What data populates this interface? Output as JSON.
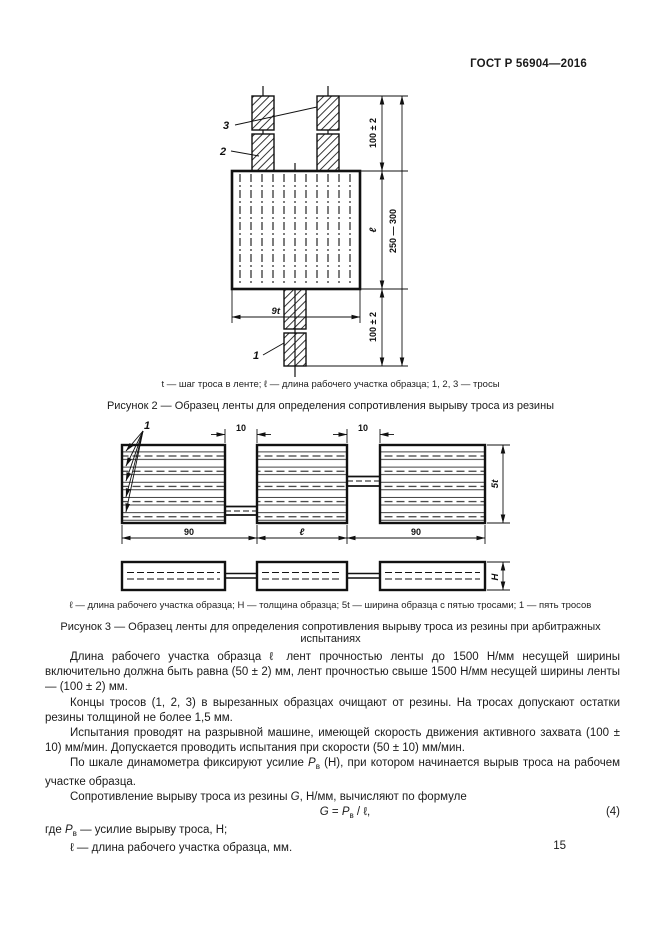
{
  "header": {
    "title": "ГОСТ Р 56904—2016"
  },
  "figure2": {
    "callout_1": "1",
    "callout_2": "2",
    "callout_3": "3",
    "dim_top": "100 ± 2",
    "dim_length": "ℓ",
    "dim_bottom": "100 ± 2",
    "dim_overall": "250 — 300",
    "dim_width": "9t",
    "legend": "t — шаг троса в ленте; ℓ — длина рабочего участка образца; 1, 2, 3 — тросы",
    "title": "Рисунок 2 — Образец ленты для определения сопротивления вырыву троса из резины"
  },
  "figure3": {
    "callout_1": "1",
    "dim_neck_left": "10",
    "dim_neck_right": "10",
    "dim_left": "90",
    "dim_middle": "ℓ",
    "dim_right": "90",
    "dim_width": "5t",
    "dim_thickness": "H",
    "legend": "ℓ — длина рабочего участка образца; H — толщина образца; 5t — ширина образца с пятью тросами; 1 — пять тросов",
    "title": "Рисунок 3 — Образец ленты для определения сопротивления вырыву троса из резины при арбитражных испытаниях"
  },
  "body": {
    "p1": "Длина рабочего участка образца ℓ лент прочностью ленты до 1500 Н/мм несущей ширины включительно должна быть равна (50 ± 2) мм, лент прочностью свыше 1500 Н/мм несущей ширины ленты — (100 ± 2) мм.",
    "p2": "Концы тросов (1, 2, 3) в вырезанных образцах очищают от резины. На тросах допускают остатки резины толщиной не более 1,5 мм.",
    "p3": "Испытания проводят на разрывной машине, имеющей скорость движения активного захвата (100 ± 10) мм/мин. Допускается проводить испытания при скорости (50 ± 10) мм/мин.",
    "p4_before": "По шкале динамометра фиксируют усилие ",
    "p4_var": "P",
    "p4_sub": "в",
    "p4_after": " (Н), при котором начинается вырыв троса на рабочем участке образца.",
    "p5_before": "Сопротивление вырыву троса из резины ",
    "p5_var": "G",
    "p5_after": ", Н/мм, вычисляют по формуле"
  },
  "formula": {
    "lhs": "G",
    "equals": " = ",
    "var": "P",
    "sub": "в",
    "tail": " / ℓ,",
    "number": "(4)"
  },
  "where": {
    "intro": "где ",
    "var": "P",
    "sub": "в",
    "line1_tail": " — усилие вырыву троса, Н;",
    "line2_var": "ℓ",
    "line2_tail": " — длина рабочего участка образца, мм."
  },
  "footer": {
    "page_number": "15"
  }
}
